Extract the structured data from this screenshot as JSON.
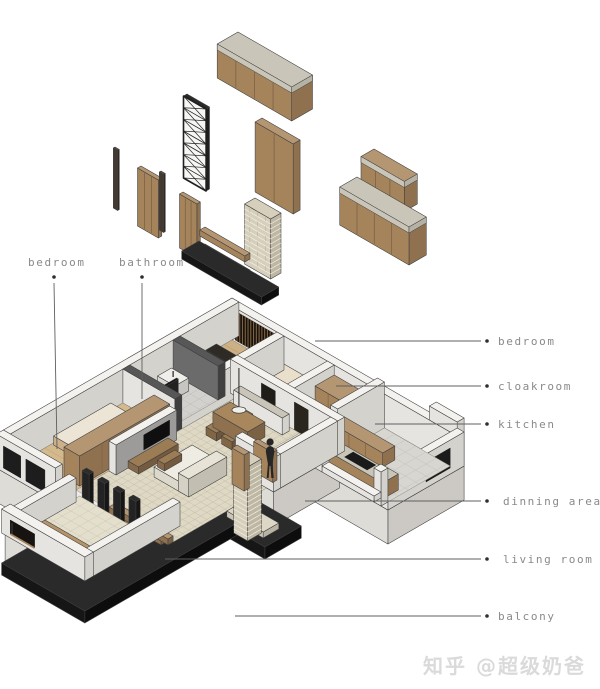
{
  "diagram": {
    "title": "apartment axonometric exploded view",
    "labels_left": [
      {
        "text": "bedroom"
      },
      {
        "text": "bathroom"
      }
    ],
    "labels_right": [
      {
        "text": "bedroom"
      },
      {
        "text": "cloakroom"
      },
      {
        "text": "kitchen"
      },
      {
        "text": "dinning area"
      },
      {
        "text": "living room"
      },
      {
        "text": "balcony"
      }
    ]
  },
  "watermark": {
    "text": "知乎 @超级奶爸"
  },
  "colors": {
    "wood": "#a5845c",
    "wood_light": "#b59672",
    "wood_dark": "#8f7150",
    "wood_deep": "#7c6245",
    "stone": "#c9c5b9",
    "wall_top": "#f3f2ef",
    "wall_front": "#e6e4e0",
    "wall_side": "#d4d2cd",
    "dark": "#1c1c1c",
    "brick": "#d6cfbc",
    "brick_side": "#beb7a3",
    "mortar": "#f4f1e8",
    "gray_wall": "#9c9b99",
    "floor_parquet": "#ded8c4",
    "floor_line": "#c6bfa8",
    "label": "#8a8a8a",
    "line": "#5f5f5f"
  }
}
